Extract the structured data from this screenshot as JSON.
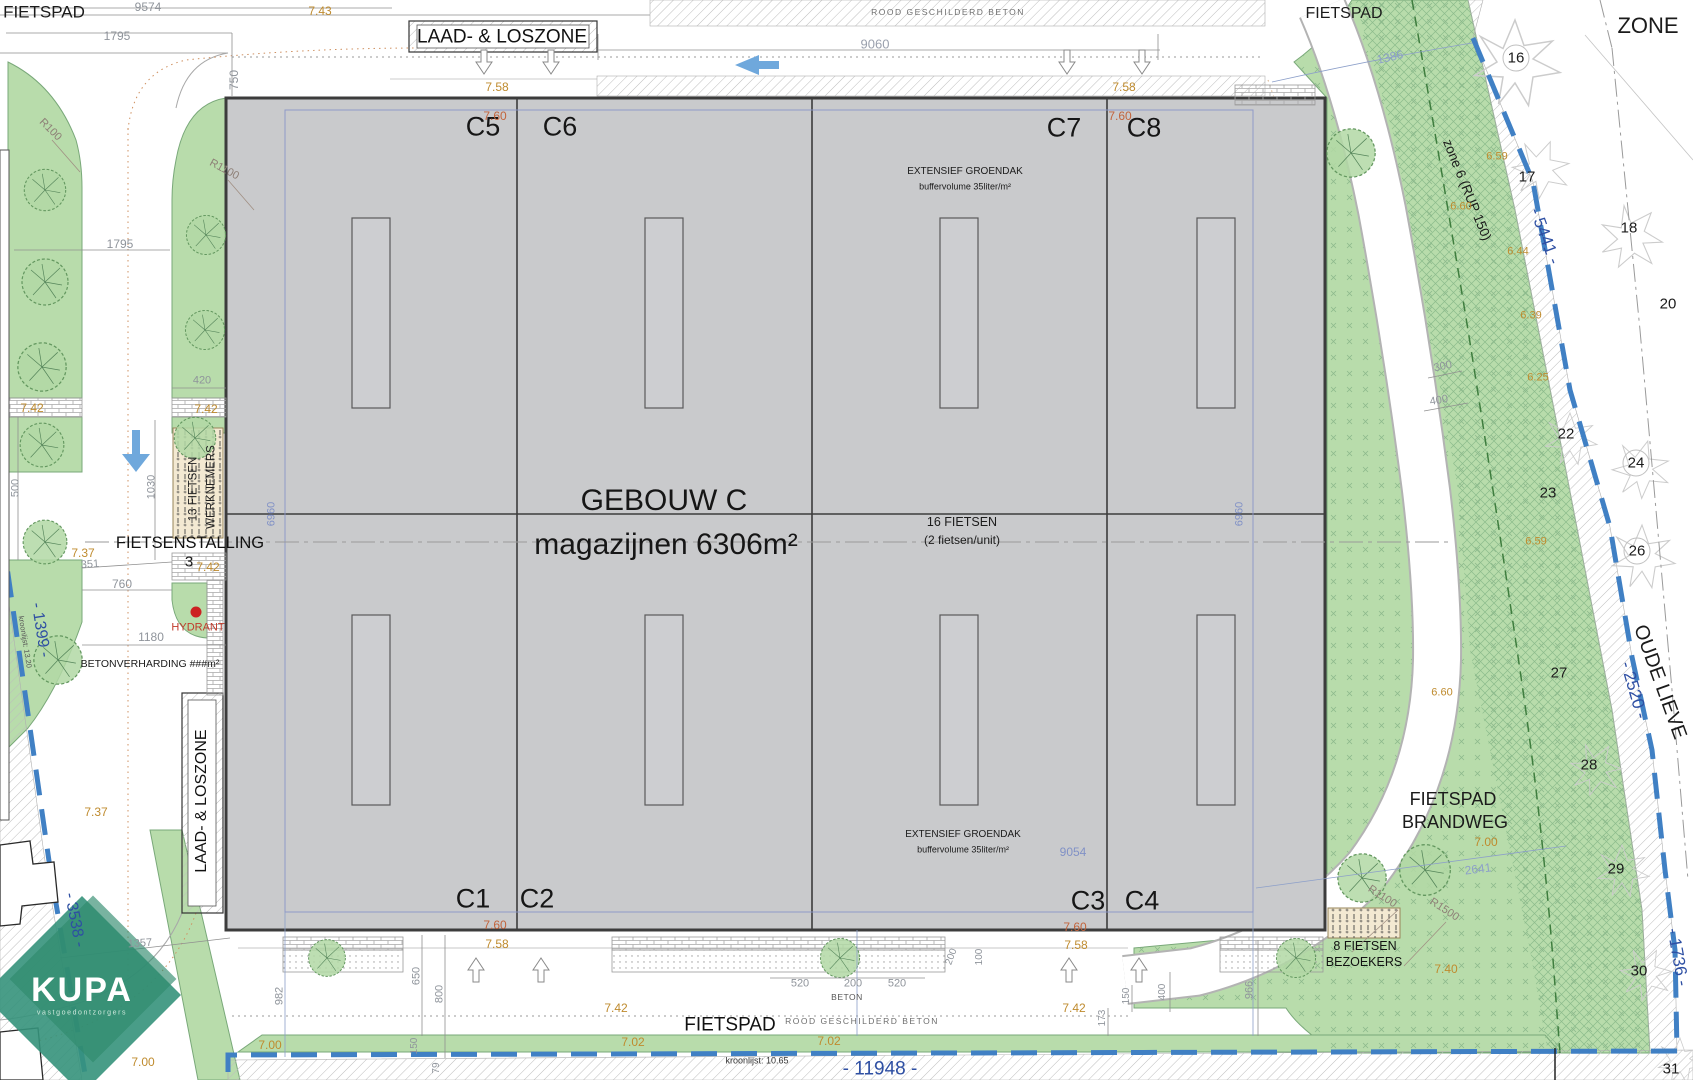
{
  "plan": {
    "building_name": "GEBOUW C",
    "building_subtitle": "magazijnen 6306m²",
    "units_top": [
      "C5",
      "C6",
      "C7",
      "C8"
    ],
    "units_bottom": [
      "C1",
      "C2",
      "C3",
      "C4"
    ],
    "palette": {
      "building_fill": "#c9cacc",
      "green": "#b8dcab",
      "boundary_blue": "#4080c4",
      "text_blue": "#2e4fa3",
      "dim_gray": "#8f949b",
      "dim_blue": "#8191c6",
      "orange": "#bf8b2e",
      "orange_red": "#c2643c",
      "red": "#c03a2b",
      "kupa_green": "#35927b",
      "arrow_blue": "#6fa8dc"
    }
  },
  "labels": [
    {
      "n": "fietspad-top-left",
      "t": "FIETSPAD",
      "x": 44,
      "y": 12,
      "s": 17
    },
    {
      "n": "dim-9574",
      "t": "9574",
      "x": 148,
      "y": 7,
      "s": 12,
      "c": "#8f949b"
    },
    {
      "n": "dim-1795-top",
      "t": "1795",
      "x": 117,
      "y": 36,
      "s": 12,
      "c": "#8f949b"
    },
    {
      "n": "lvl-743",
      "t": "7.43",
      "x": 320,
      "y": 11,
      "s": 12,
      "c": "#bf8b2e"
    },
    {
      "n": "dim-750",
      "t": "750",
      "x": 234,
      "y": 80,
      "s": 12,
      "c": "#8f949b",
      "r": -90
    },
    {
      "n": "laad-loszone-top",
      "t": "LAAD- & LOSZONE",
      "x": 502,
      "y": 37,
      "s": 19,
      "c": "#111111"
    },
    {
      "n": "dim-9060",
      "t": "9060",
      "x": 875,
      "y": 44,
      "s": 13,
      "c": "#9aa0ad"
    },
    {
      "n": "rood-beton-top",
      "t": "ROOD GESCHILDERD BETON",
      "x": 948,
      "y": 12,
      "s": 8.5,
      "c": "#6e6e6e",
      "ls": 1.5
    },
    {
      "n": "fietspad-top-right",
      "t": "FIETSPAD",
      "x": 1344,
      "y": 14,
      "s": 16
    },
    {
      "n": "zone-right",
      "t": "ZONE",
      "x": 1648,
      "y": 26,
      "s": 22
    },
    {
      "n": "dim-1386",
      "t": "1386",
      "x": 1390,
      "y": 57,
      "s": 12,
      "c": "#8c9fc9",
      "r": -13
    },
    {
      "n": "parcel-16",
      "t": "16",
      "x": 1516,
      "y": 58,
      "s": 15
    },
    {
      "n": "zone6-rup150",
      "t": "zone 6 (RUP 150)",
      "x": 1467,
      "y": 190,
      "s": 13.5,
      "r": 68
    },
    {
      "n": "bnd-5441",
      "t": "- 5441 -",
      "x": 1545,
      "y": 236,
      "s": 17,
      "c": "#2e4fa3",
      "r": 70
    },
    {
      "n": "parcel-17",
      "t": "17",
      "x": 1527,
      "y": 177,
      "s": 15
    },
    {
      "n": "lvl-659-a",
      "t": "6.59",
      "x": 1497,
      "y": 157,
      "s": 11,
      "c": "#bf8b2e"
    },
    {
      "n": "lvl-660-a",
      "t": "6.60",
      "x": 1461,
      "y": 207,
      "s": 11,
      "c": "#bf8b2e"
    },
    {
      "n": "lvl-644",
      "t": "6.44",
      "x": 1518,
      "y": 252,
      "s": 11,
      "c": "#bf8b2e"
    },
    {
      "n": "parcel-18",
      "t": "18",
      "x": 1629,
      "y": 228,
      "s": 15
    },
    {
      "n": "lvl-639",
      "t": "6.39",
      "x": 1531,
      "y": 316,
      "s": 11,
      "c": "#bf8b2e"
    },
    {
      "n": "parcel-20",
      "t": "20",
      "x": 1668,
      "y": 304,
      "s": 15
    },
    {
      "n": "lvl-625",
      "t": "6.25",
      "x": 1538,
      "y": 378,
      "s": 11,
      "c": "#bf8b2e"
    },
    {
      "n": "dim-300",
      "t": "300",
      "x": 1443,
      "y": 367,
      "s": 11,
      "c": "#8f949b",
      "r": -12
    },
    {
      "n": "dim-400-right",
      "t": "400",
      "x": 1439,
      "y": 401,
      "s": 11,
      "c": "#8f949b",
      "r": -10
    },
    {
      "n": "parcel-22",
      "t": "22",
      "x": 1566,
      "y": 434,
      "s": 15
    },
    {
      "n": "parcel-23",
      "t": "23",
      "x": 1548,
      "y": 493,
      "s": 15
    },
    {
      "n": "parcel-24",
      "t": "24",
      "x": 1636,
      "y": 463,
      "s": 15
    },
    {
      "n": "lvl-659-b",
      "t": "6.59",
      "x": 1536,
      "y": 542,
      "s": 11,
      "c": "#bf8b2e"
    },
    {
      "n": "parcel-26",
      "t": "26",
      "x": 1637,
      "y": 551,
      "s": 15
    },
    {
      "n": "parcel-27",
      "t": "27",
      "x": 1559,
      "y": 673,
      "s": 15
    },
    {
      "n": "lvl-660-b",
      "t": "6.60",
      "x": 1442,
      "y": 693,
      "s": 11,
      "c": "#bf8b2e"
    },
    {
      "n": "oude-lieve",
      "t": "OUDE LIEVE",
      "x": 1660,
      "y": 682,
      "s": 20,
      "r": 70
    },
    {
      "n": "bnd-2520",
      "t": "- 2520 -",
      "x": 1634,
      "y": 690,
      "s": 17,
      "c": "#2e4fa3",
      "r": 74
    },
    {
      "n": "parcel-28",
      "t": "28",
      "x": 1589,
      "y": 765,
      "s": 15
    },
    {
      "n": "fietspad-brandweg-line1",
      "t": "FIETSPAD",
      "x": 1453,
      "y": 799,
      "s": 18
    },
    {
      "n": "fietspad-brandweg-line2",
      "t": "BRANDWEG",
      "x": 1455,
      "y": 822,
      "s": 18
    },
    {
      "n": "lvl-700-a",
      "t": "7.00",
      "x": 1486,
      "y": 842,
      "s": 12,
      "c": "#bf8b2e"
    },
    {
      "n": "dim-2641",
      "t": "2641",
      "x": 1478,
      "y": 869,
      "s": 12,
      "c": "#8c9fc9",
      "r": -7
    },
    {
      "n": "parcel-29",
      "t": "29",
      "x": 1616,
      "y": 869,
      "s": 15
    },
    {
      "n": "rad-r1100-right",
      "t": "R1100",
      "x": 1382,
      "y": 897,
      "s": 11,
      "c": "#8d7f76",
      "r": 33
    },
    {
      "n": "rad-r1500",
      "t": "R1500",
      "x": 1444,
      "y": 910,
      "s": 11,
      "c": "#8d7f76",
      "r": 33
    },
    {
      "n": "lvl-740",
      "t": "7.40",
      "x": 1446,
      "y": 969,
      "s": 12,
      "c": "#bf8b2e"
    },
    {
      "n": "parcel-30",
      "t": "30",
      "x": 1639,
      "y": 971,
      "s": 15
    },
    {
      "n": "bnd-1736",
      "t": "- 1736 -",
      "x": 1678,
      "y": 957,
      "s": 17,
      "c": "#2e4fa3",
      "r": 80
    },
    {
      "n": "parcel-31",
      "t": "31",
      "x": 1671,
      "y": 1069,
      "s": 15
    },
    {
      "n": "fietsen8-line1",
      "t": "8 FIETSEN",
      "x": 1365,
      "y": 946,
      "s": 12.5,
      "c": "#111111"
    },
    {
      "n": "fietsen8-line2",
      "t": "BEZOEKERS",
      "x": 1364,
      "y": 962,
      "s": 12.5,
      "c": "#111111"
    },
    {
      "n": "unit-label-c5",
      "t": "C5",
      "x": 483,
      "y": 127,
      "s": 27,
      "c": "#161616"
    },
    {
      "n": "unit-label-c6",
      "t": "C6",
      "x": 560,
      "y": 127,
      "s": 27,
      "c": "#161616"
    },
    {
      "n": "unit-label-c7",
      "t": "C7",
      "x": 1064,
      "y": 128,
      "s": 27,
      "c": "#161616"
    },
    {
      "n": "unit-label-c8",
      "t": "C8",
      "x": 1144,
      "y": 128,
      "s": 27,
      "c": "#161616"
    },
    {
      "n": "unit-label-c1",
      "t": "C1",
      "x": 473,
      "y": 899,
      "s": 27,
      "c": "#161616"
    },
    {
      "n": "unit-label-c2",
      "t": "C2",
      "x": 537,
      "y": 899,
      "s": 27,
      "c": "#161616"
    },
    {
      "n": "unit-label-c3",
      "t": "C3",
      "x": 1088,
      "y": 901,
      "s": 27,
      "c": "#161616"
    },
    {
      "n": "unit-label-c4",
      "t": "C4",
      "x": 1142,
      "y": 901,
      "s": 27,
      "c": "#161616"
    },
    {
      "n": "building-title",
      "t": "GEBOUW C",
      "x": 664,
      "y": 501,
      "s": 30,
      "c": "#161616"
    },
    {
      "n": "building-subtitle",
      "t": "magazijnen 6306m²",
      "x": 666,
      "y": 545,
      "s": 30,
      "c": "#161616"
    },
    {
      "n": "groendak-top-line1",
      "t": "EXTENSIEF GROENDAK",
      "x": 965,
      "y": 172,
      "s": 10
    },
    {
      "n": "groendak-top-line2",
      "t": "buffervolume 35liter/m²",
      "x": 965,
      "y": 187,
      "s": 9
    },
    {
      "n": "groendak-bottom-line1",
      "t": "EXTENSIEF GROENDAK",
      "x": 963,
      "y": 835,
      "s": 10
    },
    {
      "n": "groendak-bottom-line2",
      "t": "buffervolume 35liter/m²",
      "x": 963,
      "y": 850,
      "s": 9
    },
    {
      "n": "fietsen16-line1",
      "t": "16 FIETSEN",
      "x": 962,
      "y": 522,
      "s": 12.5
    },
    {
      "n": "fietsen16-line2",
      "t": "(2 fietsen/unit)",
      "x": 962,
      "y": 540,
      "s": 12
    },
    {
      "n": "dim-6960-left",
      "t": "6960",
      "x": 272,
      "y": 514,
      "s": 11,
      "c": "#8191c6",
      "r": -90
    },
    {
      "n": "dim-6960-right",
      "t": "6960",
      "x": 1240,
      "y": 514,
      "s": 11,
      "c": "#8191c6",
      "r": -90
    },
    {
      "n": "dim-9054",
      "t": "9054",
      "x": 1073,
      "y": 852,
      "s": 12,
      "c": "#8191c6"
    },
    {
      "n": "lvl-758-top-left",
      "t": "7.58",
      "x": 497,
      "y": 87,
      "s": 12,
      "c": "#bf8b2e"
    },
    {
      "n": "lvl-760-top-left",
      "t": "7.60",
      "x": 495,
      "y": 116,
      "s": 12,
      "c": "#c2643c"
    },
    {
      "n": "lvl-758-top-right",
      "t": "7.58",
      "x": 1124,
      "y": 87,
      "s": 12,
      "c": "#bf8b2e"
    },
    {
      "n": "lvl-760-top-right",
      "t": "7.60",
      "x": 1120,
      "y": 116,
      "s": 12,
      "c": "#c2643c"
    },
    {
      "n": "rad-r100",
      "t": "R100",
      "x": 50,
      "y": 130,
      "s": 11,
      "c": "#8d7f76",
      "r": 45
    },
    {
      "n": "rad-r1100-left",
      "t": "R1100",
      "x": 224,
      "y": 170,
      "s": 11,
      "c": "#8d7f76",
      "r": 28
    },
    {
      "n": "dim-1795-left",
      "t": "1795",
      "x": 120,
      "y": 244,
      "s": 12,
      "c": "#8f949b"
    },
    {
      "n": "dim-420",
      "t": "420",
      "x": 202,
      "y": 381,
      "s": 11,
      "c": "#8f949b"
    },
    {
      "n": "lvl-742-a",
      "t": "7.42",
      "x": 32,
      "y": 408,
      "s": 12,
      "c": "#bf8b2e"
    },
    {
      "n": "lvl-742-b",
      "t": "7.42",
      "x": 206,
      "y": 409,
      "s": 12,
      "c": "#bf8b2e"
    },
    {
      "n": "fietsen13-line1",
      "t": "13 FIETSEN",
      "x": 194,
      "y": 489,
      "s": 11.5,
      "c": "#222222",
      "r": -90
    },
    {
      "n": "fietsen13-line2",
      "t": "WERKNEMERS",
      "x": 212,
      "y": 487,
      "s": 11.5,
      "c": "#222222",
      "r": -90
    },
    {
      "n": "fietsenstalling",
      "t": "FIETSENSTALLING",
      "x": 190,
      "y": 543,
      "s": 16.5,
      "c": "#111111"
    },
    {
      "n": "nr-3",
      "t": "3",
      "x": 189,
      "y": 562,
      "s": 15
    },
    {
      "n": "lvl-742-c",
      "t": "7.42",
      "x": 208,
      "y": 567,
      "s": 12,
      "c": "#bf8b2e"
    },
    {
      "n": "dim-500",
      "t": "500",
      "x": 16,
      "y": 488,
      "s": 11,
      "c": "#8f949b",
      "r": -90
    },
    {
      "n": "dim-1030",
      "t": "1030",
      "x": 152,
      "y": 487,
      "s": 11,
      "c": "#8f949b",
      "r": -90
    },
    {
      "n": "lvl-737-a",
      "t": "7.37",
      "x": 83,
      "y": 553,
      "s": 12,
      "c": "#bf8b2e"
    },
    {
      "n": "dim-351",
      "t": "351",
      "x": 90,
      "y": 565,
      "s": 11,
      "c": "#8f949b",
      "r": -4
    },
    {
      "n": "dim-760",
      "t": "760",
      "x": 122,
      "y": 584,
      "s": 12,
      "c": "#8f949b"
    },
    {
      "n": "hydrant-label",
      "t": "HYDRANT",
      "x": 198,
      "y": 628,
      "s": 11,
      "c": "#c03a2b"
    },
    {
      "n": "bnd-1399",
      "t": "- 1399 -",
      "x": 40,
      "y": 630,
      "s": 16,
      "c": "#2e4fa3",
      "r": 81
    },
    {
      "n": "kroonlijst-left",
      "t": "kroonlijst: 13.20",
      "x": 25,
      "y": 642,
      "s": 7.5,
      "c": "#555555",
      "r": 81
    },
    {
      "n": "dim-1180",
      "t": "1180",
      "x": 151,
      "y": 637,
      "s": 12,
      "c": "#8f949b"
    },
    {
      "n": "betonverharding",
      "t": "BETONVERHARDING ###m²",
      "x": 150,
      "y": 664,
      "s": 10.5
    },
    {
      "n": "lvl-737-b",
      "t": "7.37",
      "x": 96,
      "y": 812,
      "s": 12,
      "c": "#bf8b2e"
    },
    {
      "n": "laad-loszone-left",
      "t": "LAAD- & LOSZONE",
      "x": 202,
      "y": 801,
      "s": 16,
      "c": "#111111",
      "r": -90
    },
    {
      "n": "bnd-3538",
      "t": "- 3538 -",
      "x": 74,
      "y": 920,
      "s": 16,
      "c": "#2e4fa3",
      "r": 79
    },
    {
      "n": "dim-1357",
      "t": "1357",
      "x": 140,
      "y": 944,
      "s": 11,
      "c": "#8f949b",
      "r": -4
    },
    {
      "n": "kupa-logo-text",
      "t": "KUPA",
      "x": 82,
      "y": 990,
      "s": 34,
      "c": "#ffffff",
      "b": 1,
      "ls": 2
    },
    {
      "n": "kupa-logo-sub",
      "t": "vastgoedontzorgers",
      "x": 82,
      "y": 1013,
      "s": 7,
      "c": "#cfe9dd",
      "ls": 1.6
    },
    {
      "n": "lvl-760-bottom-left",
      "t": "7.60",
      "x": 495,
      "y": 925,
      "s": 12,
      "c": "#c2643c"
    },
    {
      "n": "lvl-758-bottom-left",
      "t": "7.58",
      "x": 497,
      "y": 944,
      "s": 12,
      "c": "#bf8b2e"
    },
    {
      "n": "lvl-760-bottom-right",
      "t": "7.60",
      "x": 1075,
      "y": 927,
      "s": 12,
      "c": "#c2643c"
    },
    {
      "n": "lvl-758-bottom-right",
      "t": "7.58",
      "x": 1076,
      "y": 945,
      "s": 12,
      "c": "#bf8b2e"
    },
    {
      "n": "dim-982",
      "t": "982",
      "x": 280,
      "y": 996,
      "s": 11,
      "c": "#8f949b",
      "r": -90
    },
    {
      "n": "dim-650",
      "t": "650",
      "x": 417,
      "y": 976,
      "s": 11,
      "c": "#8f949b",
      "r": -90
    },
    {
      "n": "dim-800",
      "t": "800",
      "x": 440,
      "y": 994,
      "s": 11,
      "c": "#8f949b",
      "r": -90
    },
    {
      "n": "dim-150-a",
      "t": "150",
      "x": 415,
      "y": 1046,
      "s": 10,
      "c": "#8f949b",
      "r": -90
    },
    {
      "n": "dim-79",
      "t": "79",
      "x": 437,
      "y": 1068,
      "s": 10,
      "c": "#8f949b",
      "r": -90
    },
    {
      "n": "dim-200-a",
      "t": "200",
      "x": 952,
      "y": 957,
      "s": 10,
      "c": "#8f949b",
      "r": -70
    },
    {
      "n": "dim-100",
      "t": "100",
      "x": 980,
      "y": 957,
      "s": 10,
      "c": "#8f949b",
      "r": -90
    },
    {
      "n": "dim-520-a",
      "t": "520",
      "x": 800,
      "y": 984,
      "s": 11,
      "c": "#8f949b"
    },
    {
      "n": "dim-200-b",
      "t": "200",
      "x": 853,
      "y": 984,
      "s": 11,
      "c": "#8f949b"
    },
    {
      "n": "dim-520-b",
      "t": "520",
      "x": 897,
      "y": 984,
      "s": 11,
      "c": "#8f949b"
    },
    {
      "n": "beton-label",
      "t": "BETON",
      "x": 847,
      "y": 997,
      "s": 8.5,
      "c": "#555555",
      "ls": 0.5
    },
    {
      "n": "lvl-742-d",
      "t": "7.42",
      "x": 616,
      "y": 1008,
      "s": 12,
      "c": "#bf8b2e"
    },
    {
      "n": "lvl-742-e",
      "t": "7.42",
      "x": 1074,
      "y": 1008,
      "s": 12,
      "c": "#bf8b2e"
    },
    {
      "n": "fietspad-bottom",
      "t": "FIETSPAD",
      "x": 730,
      "y": 1025,
      "s": 19,
      "c": "#111111"
    },
    {
      "n": "rood-beton-bottom",
      "t": "ROOD GESCHILDERD BETON",
      "x": 862,
      "y": 1021,
      "s": 8.5,
      "c": "#6e6e6e",
      "ls": 1.5
    },
    {
      "n": "lvl-702-a",
      "t": "7.02",
      "x": 633,
      "y": 1042,
      "s": 12,
      "c": "#bf8b2e"
    },
    {
      "n": "lvl-702-b",
      "t": "7.02",
      "x": 829,
      "y": 1041,
      "s": 12,
      "c": "#bf8b2e"
    },
    {
      "n": "lvl-700-b",
      "t": "7.00",
      "x": 270,
      "y": 1045,
      "s": 12,
      "c": "#bf8b2e"
    },
    {
      "n": "lvl-700-c",
      "t": "7.00",
      "x": 143,
      "y": 1062,
      "s": 12,
      "c": "#bf8b2e"
    },
    {
      "n": "kroonlijst-bottom",
      "t": "kroonlijst: 10.65",
      "x": 757,
      "y": 1061,
      "s": 9,
      "c": "#333333"
    },
    {
      "n": "bnd-11948",
      "t": "- 11948 -",
      "x": 880,
      "y": 1069,
      "s": 19,
      "c": "#2e4fa3"
    },
    {
      "n": "dim-173",
      "t": "173",
      "x": 1103,
      "y": 1018,
      "s": 10,
      "c": "#8f949b",
      "r": -90
    },
    {
      "n": "dim-150-b",
      "t": "150",
      "x": 1127,
      "y": 996,
      "s": 10,
      "c": "#8f949b",
      "r": -90
    },
    {
      "n": "dim-400-b",
      "t": "400",
      "x": 1163,
      "y": 992,
      "s": 10,
      "c": "#8f949b",
      "r": -90
    },
    {
      "n": "dim-966",
      "t": "966",
      "x": 1250,
      "y": 990,
      "s": 11,
      "c": "#8f949b",
      "r": -90
    }
  ]
}
